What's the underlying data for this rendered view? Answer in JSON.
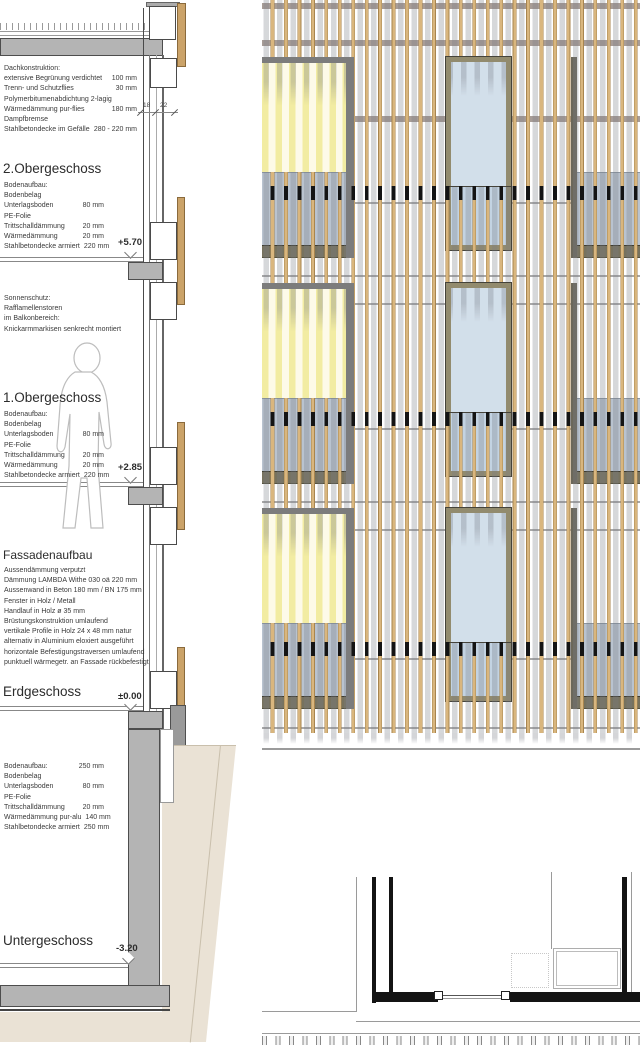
{
  "annotations": {
    "dach": {
      "title": "Dachkonstruktion:",
      "rows": [
        {
          "label": "extensive Begrünung verdichtet",
          "value": "100 mm"
        },
        {
          "label": "Trenn- und Schutzflies",
          "value": "30 mm"
        },
        {
          "label": "Polymerbitumenabdichtung 2-lagig",
          "value": ""
        },
        {
          "label": "Wärmedämmung pur-flies",
          "value": "180 mm"
        },
        {
          "label": "Dampfbremse",
          "value": ""
        },
        {
          "label": "Stahlbetondecke im Gefälle",
          "value": "280 - 220 mm"
        }
      ]
    },
    "og2": {
      "title": "2.Obergeschoss",
      "level": "+5.70",
      "rows": [
        {
          "label": "Bodenaufbau:",
          "value": ""
        },
        {
          "label": "Bodenbelag",
          "value": ""
        },
        {
          "label": "Unterlagsboden",
          "value": "80 mm"
        },
        {
          "label": "PE-Folie",
          "value": ""
        },
        {
          "label": "Trittschalldämmung",
          "value": "20 mm"
        },
        {
          "label": "Wärmedämmung",
          "value": "20 mm"
        },
        {
          "label": "Stahlbetondecke armiert",
          "value": "220 mm"
        }
      ]
    },
    "sonnenschutz": {
      "lines": [
        "Sonnenschutz:",
        "Rafflamellenstoren",
        "im Balkonbereich:",
        "Knickarmmarkisen senkrecht montiert"
      ]
    },
    "og1": {
      "title": "1.Obergeschoss",
      "level": "+2.85",
      "rows": [
        {
          "label": "Bodenaufbau:",
          "value": ""
        },
        {
          "label": "Bodenbelag",
          "value": ""
        },
        {
          "label": "Unterlagsboden",
          "value": "80 mm"
        },
        {
          "label": "PE-Folie",
          "value": ""
        },
        {
          "label": "Trittschalldämmung",
          "value": "20 mm"
        },
        {
          "label": "Wärmedämmung",
          "value": "20 mm"
        },
        {
          "label": "Stahlbetondecke armiert",
          "value": "220 mm"
        }
      ]
    },
    "fassade": {
      "title": "Fassadenaufbau",
      "lines": [
        "Aussendämmung verputzt",
        "Dämmung LAMBDA Withe 030 oä  220 mm",
        "Aussenwand in Beton 180 mm / BN 175 mm",
        "Fenster in Holz / Metall",
        "Handlauf in Holz ø 35 mm",
        "Brüstungskonstruktion umlaufend",
        "vertikale Profile in Holz 24 x 48 mm natur",
        "alternativ in Aluminium eloxiert ausgeführt",
        "horizontale Befestigungstraversen umlaufend",
        "punktuell  wärmegetr. an Fassade rückbefestigt"
      ]
    },
    "eg": {
      "title": "Erdgeschoss",
      "level": "±0.00"
    },
    "ug_boden": {
      "rows": [
        {
          "label": "Bodenaufbau:",
          "value": "250 mm"
        },
        {
          "label": "Bodenbelag",
          "value": ""
        },
        {
          "label": "Unterlagsboden",
          "value": "80 mm"
        },
        {
          "label": "PE-Folie",
          "value": ""
        },
        {
          "label": "Trittschalldämmung",
          "value": "20 mm"
        },
        {
          "label": "Wärmedämmung pur-alu",
          "value": "140 mm"
        },
        {
          "label": "Stahlbetondecke armiert",
          "value": "250 mm"
        }
      ]
    },
    "ug": {
      "title": "Untergeschoss",
      "level": "-3.20"
    },
    "dims": {
      "d18": "18",
      "d22": "22"
    }
  },
  "colors": {
    "timber_slat": "#d9b67e",
    "window_glass": "#d2dfea",
    "balustrade_glass": "#b9c3cf",
    "awning_yellow": "#f2eca2",
    "concrete": "#b4b4b4",
    "earth": "#eae2d5"
  }
}
